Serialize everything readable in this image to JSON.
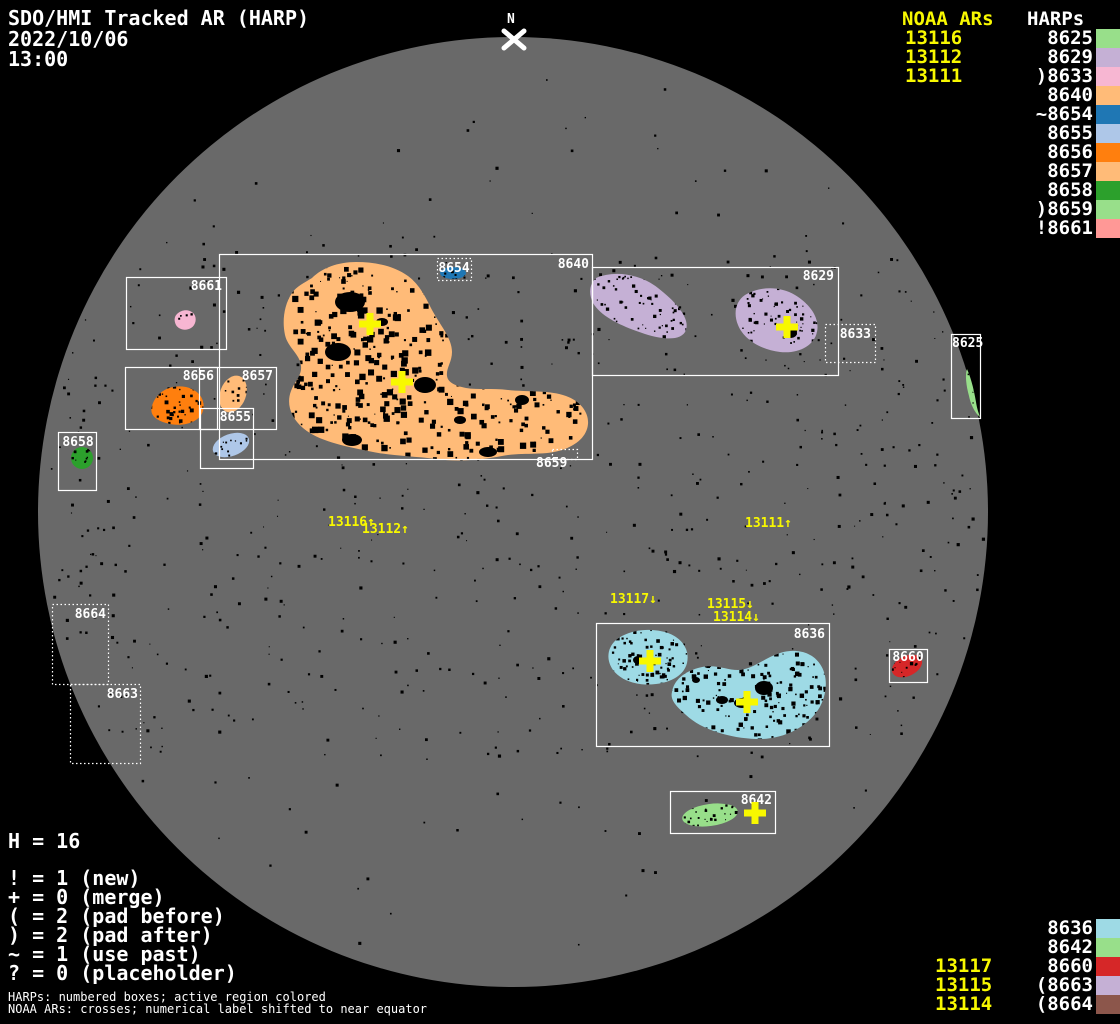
{
  "header": {
    "title": "SDO/HMI Tracked AR (HARP)",
    "date": "2022/10/06",
    "time": "13:00"
  },
  "north": {
    "label": "N"
  },
  "colors": {
    "text": "#ffffff",
    "noaa_yellow": "#f8f800",
    "disk_gray": "#696969",
    "background": "#000000",
    "box_stroke": "#ffffff"
  },
  "legend_top": {
    "noaa_header": "NOAA ARs",
    "harps_header": "HARPs",
    "noaa_items": [
      "13116",
      "13112",
      "13111"
    ],
    "harp_items": [
      {
        "label": "8625",
        "color": "#98df8a"
      },
      {
        "label": "8629",
        "color": "#c5b0d5"
      },
      {
        "label": ")8633",
        "color": "#f7b6d2"
      },
      {
        "label": "8640",
        "color": "#ffbb78"
      },
      {
        "label": "~8654",
        "color": "#1f77b4"
      },
      {
        "label": "8655",
        "color": "#aec7e8"
      },
      {
        "label": "8656",
        "color": "#ff7f0e"
      },
      {
        "label": "8657",
        "color": "#ffbb78"
      },
      {
        "label": "8658",
        "color": "#2ca02c"
      },
      {
        "label": ")8659",
        "color": "#98df8a"
      },
      {
        "label": "!8661",
        "color": "#ff9896"
      }
    ]
  },
  "legend_bottom": {
    "noaa_items": [
      "13117",
      "13115",
      "13114"
    ],
    "harp_items": [
      {
        "label": "8636",
        "color": "#9edae5"
      },
      {
        "label": "8642",
        "color": "#98df8a"
      },
      {
        "label": "8660",
        "color": "#d62728"
      },
      {
        "label": "(8663",
        "color": "#c5b0d5"
      },
      {
        "label": "(8664",
        "color": "#8c564b"
      }
    ]
  },
  "stats": {
    "h_line": "H = 16",
    "legend_lines": [
      "! = 1 (new)",
      "+ = 0 (merge)",
      "( = 2 (pad before)",
      ") = 2 (pad after)",
      "~ = 1 (use past)",
      "? = 0 (placeholder)"
    ]
  },
  "footnotes": [
    "HARPs: numbered boxes; active region colored",
    "NOAA ARs: crosses; numerical label shifted to near equator"
  ],
  "chart_data": {
    "type": "scatter",
    "title": "SDO/HMI Tracked AR (HARP)",
    "datetime": "2022/10/06 13:00",
    "harp_total": 16,
    "disk": {
      "cx": 513,
      "cy": 512,
      "r": 475,
      "color": "#696969"
    },
    "harp_boxes": [
      {
        "harp": "8661",
        "x": 126,
        "y": 277,
        "w": 100,
        "h": 72,
        "style": "solid",
        "label": {
          "x": 222,
          "y": 290,
          "anchor": "end"
        }
      },
      {
        "harp": "8640",
        "x": 219,
        "y": 254,
        "w": 373,
        "h": 205,
        "style": "solid",
        "label": {
          "x": 589,
          "y": 268,
          "anchor": "end"
        }
      },
      {
        "harp": "8656",
        "x": 125,
        "y": 367,
        "w": 92,
        "h": 62,
        "style": "solid",
        "label": {
          "x": 214,
          "y": 380,
          "anchor": "end"
        }
      },
      {
        "harp": "8657",
        "x": 199,
        "y": 367,
        "w": 77,
        "h": 62,
        "style": "solid",
        "label": {
          "x": 273,
          "y": 380,
          "anchor": "end"
        }
      },
      {
        "harp": "8655",
        "x": 200,
        "y": 408,
        "w": 53,
        "h": 60,
        "style": "solid",
        "label": {
          "x": 251,
          "y": 421,
          "anchor": "end"
        }
      },
      {
        "harp": "8658",
        "x": 58,
        "y": 432,
        "w": 38,
        "h": 58,
        "style": "solid",
        "label": {
          "x": 78,
          "y": 446,
          "anchor": "middle"
        }
      },
      {
        "harp": "8629",
        "x": 592,
        "y": 267,
        "w": 246,
        "h": 108,
        "style": "solid",
        "label": {
          "x": 834,
          "y": 280,
          "anchor": "end"
        }
      },
      {
        "harp": "8633",
        "x": 825,
        "y": 324,
        "w": 50,
        "h": 38,
        "style": "dotted",
        "label": {
          "x": 871,
          "y": 338,
          "anchor": "end"
        }
      },
      {
        "harp": "8625",
        "x": 951,
        "y": 334,
        "w": 29,
        "h": 84,
        "style": "solid",
        "label": {
          "x": 952,
          "y": 347,
          "anchor": "start"
        }
      },
      {
        "harp": "8664",
        "x": 52,
        "y": 604,
        "w": 56,
        "h": 80,
        "style": "dotted",
        "label": {
          "x": 106,
          "y": 618,
          "anchor": "end"
        }
      },
      {
        "harp": "8663",
        "x": 70,
        "y": 684,
        "w": 70,
        "h": 79,
        "style": "dotted",
        "label": {
          "x": 138,
          "y": 698,
          "anchor": "end"
        }
      },
      {
        "harp": "8636",
        "x": 596,
        "y": 623,
        "w": 233,
        "h": 123,
        "style": "solid",
        "label": {
          "x": 825,
          "y": 638,
          "anchor": "end"
        }
      },
      {
        "harp": "8660",
        "x": 889,
        "y": 649,
        "w": 38,
        "h": 33,
        "style": "solid",
        "label": {
          "x": 908,
          "y": 661,
          "anchor": "middle"
        }
      },
      {
        "harp": "8642",
        "x": 670,
        "y": 791,
        "w": 105,
        "h": 42,
        "style": "solid",
        "label": {
          "x": 772,
          "y": 804,
          "anchor": "end"
        }
      },
      {
        "harp": "8654",
        "x": 437,
        "y": 258,
        "w": 34,
        "h": 22,
        "style": "dotted",
        "label": {
          "x": 454,
          "y": 272,
          "anchor": "middle"
        }
      },
      {
        "harp": "8659",
        "x": 552,
        "y": 449,
        "w": 25,
        "h": 10,
        "style": "dotted",
        "label": {
          "x": 536,
          "y": 467,
          "anchor": "start"
        }
      }
    ],
    "regions": [
      {
        "harp": "8640",
        "color": "#ffbb78",
        "shape": {
          "type": "path",
          "d": "M 312,278 C 322,268 338,262 356,262 C 376,262 394,266 408,276 C 420,285 426,298 432,310 C 440,325 452,338 452,352 C 452,362 446,368 447,376 C 448,383 456,386 466,388 C 478,390 492,388 508,390 C 528,392 550,390 566,396 C 580,401 589,412 588,424 C 587,436 577,445 562,450 C 544,456 522,452 502,456 C 480,460 458,462 436,459 C 412,456 390,456 368,451 C 344,446 318,441 303,428 C 291,418 286,404 291,391 C 294,382 302,376 301,366 C 300,354 288,348 285,335 C 282,321 284,305 292,293 C 297,286 304,283 312,278 Z"
        },
        "bbox": [
          285,
          262,
          304,
          198
        ],
        "speckles": 560,
        "smax": 6.5,
        "dark_spots": [
          [
            350,
            302,
            15,
            10
          ],
          [
            338,
            352,
            13,
            9
          ],
          [
            425,
            385,
            11,
            8
          ],
          [
            352,
            440,
            10,
            6
          ],
          [
            488,
            452,
            9,
            5
          ],
          [
            522,
            400,
            7,
            5
          ],
          [
            460,
            420,
            6,
            4
          ],
          [
            382,
            322,
            6,
            4
          ]
        ]
      },
      {
        "harp": "8629",
        "color": "#c5b0d5",
        "shape": {
          "type": "path",
          "d": "M 596,278 C 615,270 640,274 658,288 C 676,302 690,318 686,330 C 682,341 664,340 645,334 C 624,327 602,318 593,303 C 588,293 590,283 596,278 Z"
        },
        "bbox": [
          590,
          272,
          100,
          68
        ],
        "speckles": 90,
        "smax": 3.5,
        "dark_spots": []
      },
      {
        "harp": "8629",
        "color": "#c5b0d5",
        "shape": {
          "type": "path",
          "d": "M 745,295 C 760,286 780,286 795,295 C 810,304 820,318 817,332 C 814,346 798,354 780,352 C 762,350 744,340 738,325 C 733,313 736,301 745,295 Z"
        },
        "bbox": [
          734,
          287,
          86,
          67
        ],
        "speckles": 80,
        "smax": 3.5,
        "dark_spots": [
          [
            791,
            333,
            6,
            5
          ]
        ]
      },
      {
        "harp": "8636",
        "color": "#9edae5",
        "shape": {
          "type": "path",
          "d": "M 616,640 C 628,630 650,627 668,633 C 682,638 690,650 687,663 C 684,675 672,682 656,684 C 640,686 622,682 613,670 C 606,660 607,648 616,640 Z"
        },
        "bbox": [
          607,
          628,
          82,
          57
        ],
        "speckles": 90,
        "smax": 4,
        "dark_spots": [
          [
            638,
            660,
            5,
            4
          ]
        ]
      },
      {
        "harp": "8636",
        "color": "#9edae5",
        "shape": {
          "type": "path",
          "d": "M 672,692 C 674,680 684,672 698,668 C 714,663 726,670 738,670 C 752,670 764,658 780,653 C 796,648 812,652 820,664 C 829,677 827,696 818,710 C 806,728 782,740 756,739 C 730,738 702,730 686,715 C 676,706 670,700 672,692 Z"
        },
        "bbox": [
          668,
          650,
          160,
          90
        ],
        "speckles": 200,
        "smax": 4.5,
        "dark_spots": [
          [
            764,
            688,
            9,
            7
          ],
          [
            742,
            703,
            8,
            5
          ],
          [
            722,
            700,
            6,
            4
          ],
          [
            696,
            680,
            4,
            3
          ]
        ]
      },
      {
        "harp": "8656",
        "color": "#ff7f0e",
        "shape": {
          "type": "path",
          "d": "M 152,406 C 156,392 170,384 186,387 C 199,390 206,400 203,411 C 200,421 186,427 170,424 C 157,421 149,416 152,406 Z"
        },
        "bbox": [
          148,
          384,
          58,
          42
        ],
        "speckles": 45,
        "smax": 4,
        "dark_spots": []
      },
      {
        "harp": "8661",
        "color": "#f7b6d2",
        "shape": {
          "type": "path",
          "d": "M 177,314 C 182,309 190,309 194,314 C 197,318 196,325 191,328 C 186,331 179,330 176,325 C 174,321 174,317 177,314 Z"
        },
        "bbox": [
          175,
          309,
          21,
          21
        ],
        "speckles": 8,
        "smax": 2.5,
        "dark_spots": []
      },
      {
        "harp": "8625",
        "color": "#98df8a",
        "shape": {
          "type": "path",
          "d": "M 967,369 C 971,378 974,390 976,402 C 977,409 979,414 980,417 C 976,414 971,406 969,396 C 966,385 965,375 967,369 Z"
        },
        "bbox": [
          965,
          369,
          15,
          48
        ],
        "speckles": 5,
        "smax": 2,
        "dark_spots": []
      },
      {
        "harp": "8657",
        "color": "#ffbb78",
        "shape": {
          "type": "ellipse",
          "cx": 233,
          "cy": 394,
          "rx": 13,
          "ry": 19,
          "rot": 20
        },
        "bbox": [
          219,
          376,
          28,
          38
        ],
        "speckles": 16,
        "smax": 3,
        "dark_spots": []
      },
      {
        "harp": "8655",
        "color": "#aec7e8",
        "shape": {
          "type": "ellipse",
          "cx": 231,
          "cy": 445,
          "rx": 19,
          "ry": 11,
          "rot": -20
        },
        "bbox": [
          212,
          434,
          38,
          22
        ],
        "speckles": 14,
        "smax": 3,
        "dark_spots": []
      },
      {
        "harp": "8654",
        "color": "#1f77b4",
        "shape": {
          "type": "ellipse",
          "cx": 453,
          "cy": 273,
          "rx": 13,
          "ry": 6,
          "rot": 0
        },
        "bbox": [
          440,
          267,
          27,
          12
        ],
        "speckles": 10,
        "smax": 3,
        "dark_spots": []
      },
      {
        "harp": "8658",
        "color": "#2ca02c",
        "shape": {
          "type": "ellipse",
          "cx": 82,
          "cy": 458,
          "rx": 11,
          "ry": 11,
          "rot": 0
        },
        "bbox": [
          71,
          447,
          22,
          22
        ],
        "speckles": 10,
        "smax": 3,
        "dark_spots": []
      },
      {
        "harp": "8660",
        "color": "#d62728",
        "shape": {
          "type": "ellipse",
          "cx": 907,
          "cy": 666,
          "rx": 16,
          "ry": 10,
          "rot": -25
        },
        "bbox": [
          891,
          656,
          32,
          21
        ],
        "speckles": 14,
        "smax": 3.5,
        "dark_spots": []
      },
      {
        "harp": "8642",
        "color": "#98df8a",
        "shape": {
          "type": "ellipse",
          "cx": 710,
          "cy": 815,
          "rx": 28,
          "ry": 11,
          "rot": -8
        },
        "bbox": [
          683,
          804,
          55,
          23
        ],
        "speckles": 30,
        "smax": 3.5,
        "dark_spots": []
      }
    ],
    "noaa_crosses": [
      {
        "x": 370,
        "y": 324
      },
      {
        "x": 402,
        "y": 382
      },
      {
        "x": 787,
        "y": 327
      },
      {
        "x": 650,
        "y": 661
      },
      {
        "x": 747,
        "y": 702
      },
      {
        "x": 755,
        "y": 813
      }
    ],
    "noaa_shifted_labels": [
      {
        "text": "13116↑",
        "x": 328,
        "y": 516
      },
      {
        "text": "13112↑",
        "x": 362,
        "y": 523
      },
      {
        "text": "13111↑",
        "x": 745,
        "y": 517
      },
      {
        "text": "13117↓",
        "x": 610,
        "y": 593
      },
      {
        "text": "13115↓",
        "x": 707,
        "y": 598
      },
      {
        "text": "13114↓",
        "x": 713,
        "y": 611
      }
    ]
  }
}
